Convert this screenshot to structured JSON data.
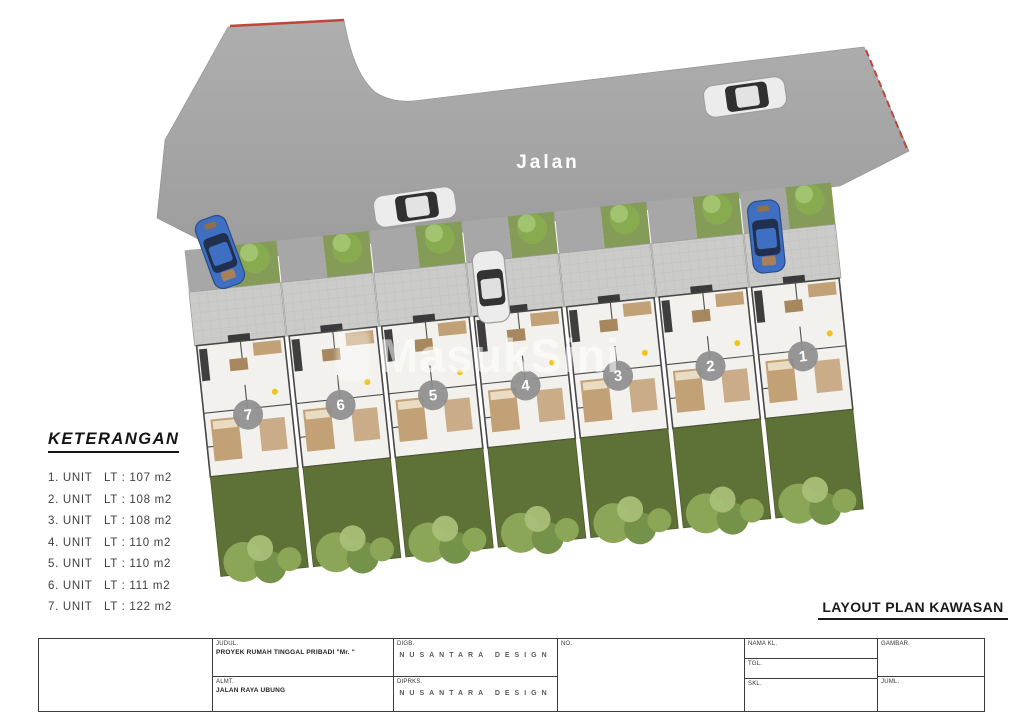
{
  "site": {
    "road_label": "Jalan",
    "watermark": "MasukSini",
    "units": [
      {
        "number": "1"
      },
      {
        "number": "2"
      },
      {
        "number": "3"
      },
      {
        "number": "4"
      },
      {
        "number": "5"
      },
      {
        "number": "6"
      },
      {
        "number": "7"
      }
    ]
  },
  "legend": {
    "title": "KETERANGAN",
    "items": [
      "1. UNIT   LT : 107 m2",
      "2. UNIT   LT : 108 m2",
      "3. UNIT   LT : 108 m2",
      "4. UNIT   LT : 110 m2",
      "5. UNIT   LT : 110 m2",
      "6. UNIT   LT : 111 m2",
      "7. UNIT   LT : 122 m2"
    ]
  },
  "caption": "LAYOUT PLAN KAWASAN",
  "title_block": {
    "judul_label": "JUDUL.",
    "judul_value": "PROYEK RUMAH TINGGAL PRIBADI \"Mr. \"",
    "almt_label": "ALMT.",
    "almt_value": "JALAN RAYA UBUNG",
    "digb_label": "DIGB.",
    "digb_value": "NUSANTARA DESIGN",
    "diprks_label": "DIPRKS.",
    "diprks_value": "NUSANTARA DESIGN",
    "no_cell_label": "NO.",
    "nama_label": "NAMA KL.",
    "tgl_label": "TGL.",
    "skl_label": "SKL.",
    "gambar_label": "GAMBAR.",
    "juml_label": "JUML."
  },
  "colors": {
    "road_light": "#aeaeae",
    "road_dark": "#9c9c9c",
    "drive": "#a7a7a7",
    "grass": "#859c58",
    "garden": "#5e7136",
    "bush": "#8ba656",
    "bush_dark": "#74924a",
    "bush_light": "#a9bf78",
    "tree_dark": "#88ab50",
    "tree_light": "#a5c573",
    "floor": "#f2f1ed",
    "paving": "#cbcbc9",
    "furniture": "#c3a176",
    "furniture_dark": "#a7875d",
    "boundary_red": "#c0453a",
    "circle_gray": "#8e8e8e",
    "blue_car": "#3f6fc2",
    "white_car": "#ececec"
  }
}
